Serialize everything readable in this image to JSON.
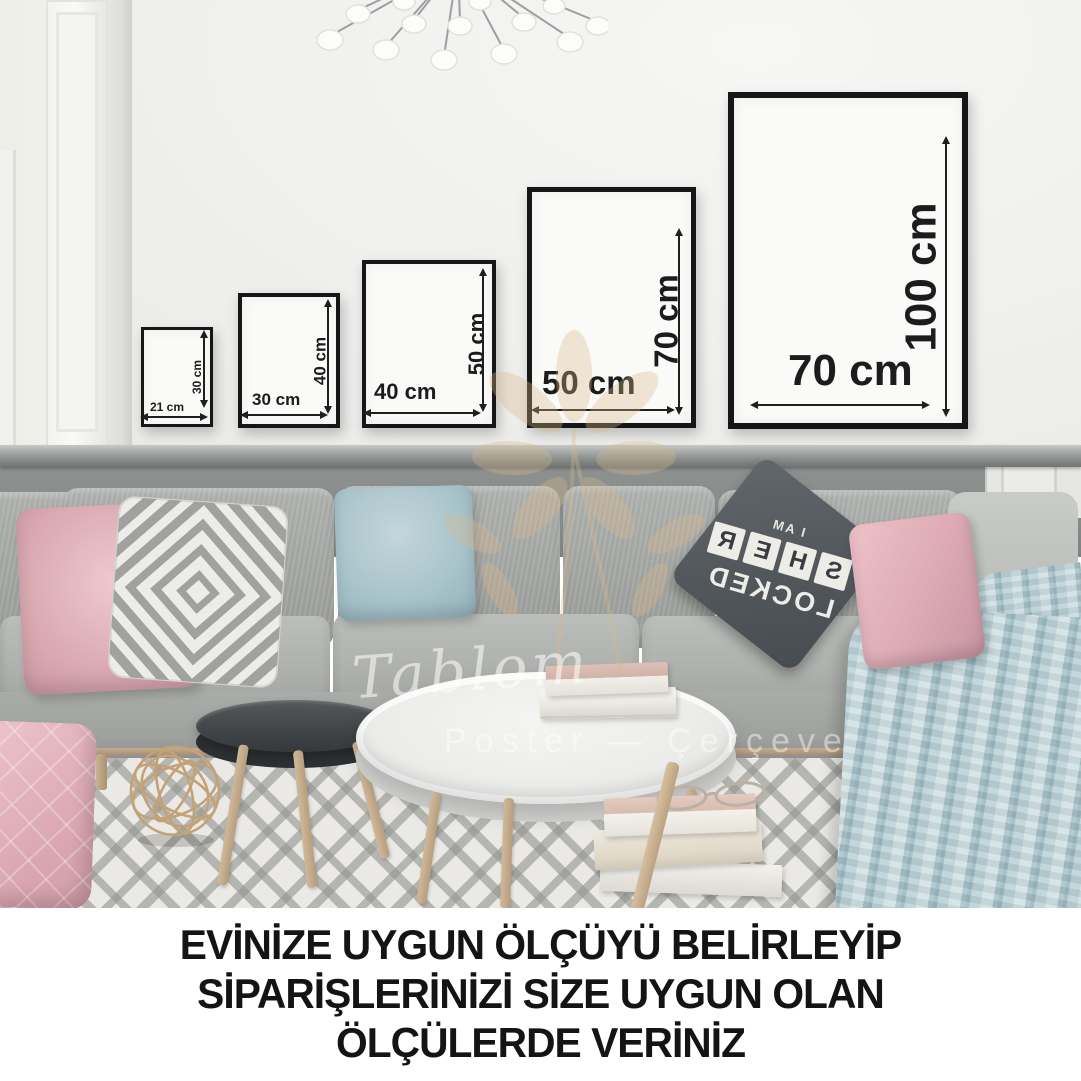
{
  "caption": {
    "lines": [
      "EVİNİZE UYGUN ÖLÇÜYÜ BELİRLEYİP",
      "SİPARİŞLERİNİZİ SİZE UYGUN OLAN",
      "ÖLÇÜLERDE VERİNİZ"
    ]
  },
  "frames": [
    {
      "id": "frame-21x30",
      "width_label": "21 cm",
      "height_label": "30 cm"
    },
    {
      "id": "frame-30x40",
      "width_label": "30 cm",
      "height_label": "40 cm"
    },
    {
      "id": "frame-40x50",
      "width_label": "40 cm",
      "height_label": "50 cm"
    },
    {
      "id": "frame-50x70",
      "width_label": "50 cm",
      "height_label": "70 cm"
    },
    {
      "id": "frame-70x100",
      "width_label": "70 cm",
      "height_label": "100 cm"
    }
  ],
  "watermark": {
    "brand_script": "Tablom",
    "subtitle": "Poster — Çerçeve"
  },
  "pillow_print": {
    "line_top": "I AM",
    "tiles": [
      "S",
      "H",
      "E",
      "R"
    ],
    "line_bottom": "LOCKED"
  },
  "colors": {
    "frame_border": "#161616",
    "wall_upper": "#f0f0ee",
    "wainscot_gray": "#868a89",
    "sofa_gray": "#a9aba8",
    "pillow_pink": "#ddadb5",
    "pillow_blue": "#aac4cb",
    "pillow_dark": "#53585d",
    "blanket_blue": "#bcd3d9",
    "rug_base": "#eae9e5",
    "rug_line": "#92948f",
    "wood": "#c2ab8c",
    "caption_text": "#141414",
    "watermark_tan": "#dcbf96"
  }
}
